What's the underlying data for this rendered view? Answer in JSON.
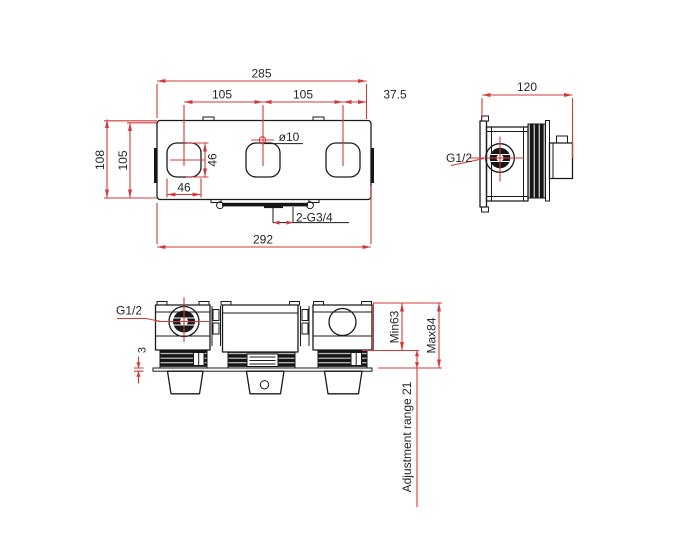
{
  "front_view": {
    "width": "285",
    "pitch_left": "105",
    "pitch_right": "105",
    "edge_offset": "37.5",
    "overall_height": "108",
    "plate_height": "105",
    "handle_width": "46",
    "handle_height": "46",
    "hole_diameter": "ø10",
    "outlet_thread": "2-G3/4",
    "overall_width": "292"
  },
  "side_view": {
    "depth": "120",
    "inlet_thread": "G1/2"
  },
  "bottom_view": {
    "inlet_thread": "G1/2",
    "plate_thickness": "3",
    "min_depth": "Min63",
    "max_depth": "Max84",
    "adjustment_range": "Adjustment range 21"
  },
  "colors": {
    "dimension_red": "#d43a3a",
    "line_black": "#1a1a1a",
    "background": "#ffffff"
  }
}
